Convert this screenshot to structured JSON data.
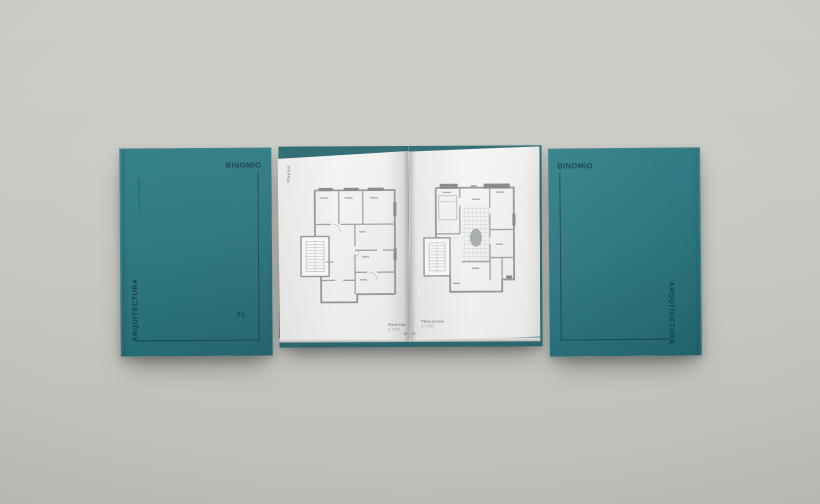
{
  "background": {
    "color": "#cacbc5"
  },
  "brand": {
    "accent_teal": "#26737b",
    "ink": "#0d3b42"
  },
  "front_cover": {
    "brand_name": "BINOMIO",
    "project_label": "Casa en Madrid",
    "category_label": "ARQUITECTURA",
    "issue_number": "01"
  },
  "open_spread": {
    "section_label": "Plantas",
    "left_page": {
      "caption": "Planta baja",
      "scale_note": "E 1:100",
      "page_number": "18"
    },
    "right_page": {
      "caption": "Planta primera",
      "scale_note": "E 1:100",
      "page_number": "19"
    }
  },
  "back_cover": {
    "brand_name": "BINOMIO",
    "category_label": "ARQUITECTURA"
  }
}
